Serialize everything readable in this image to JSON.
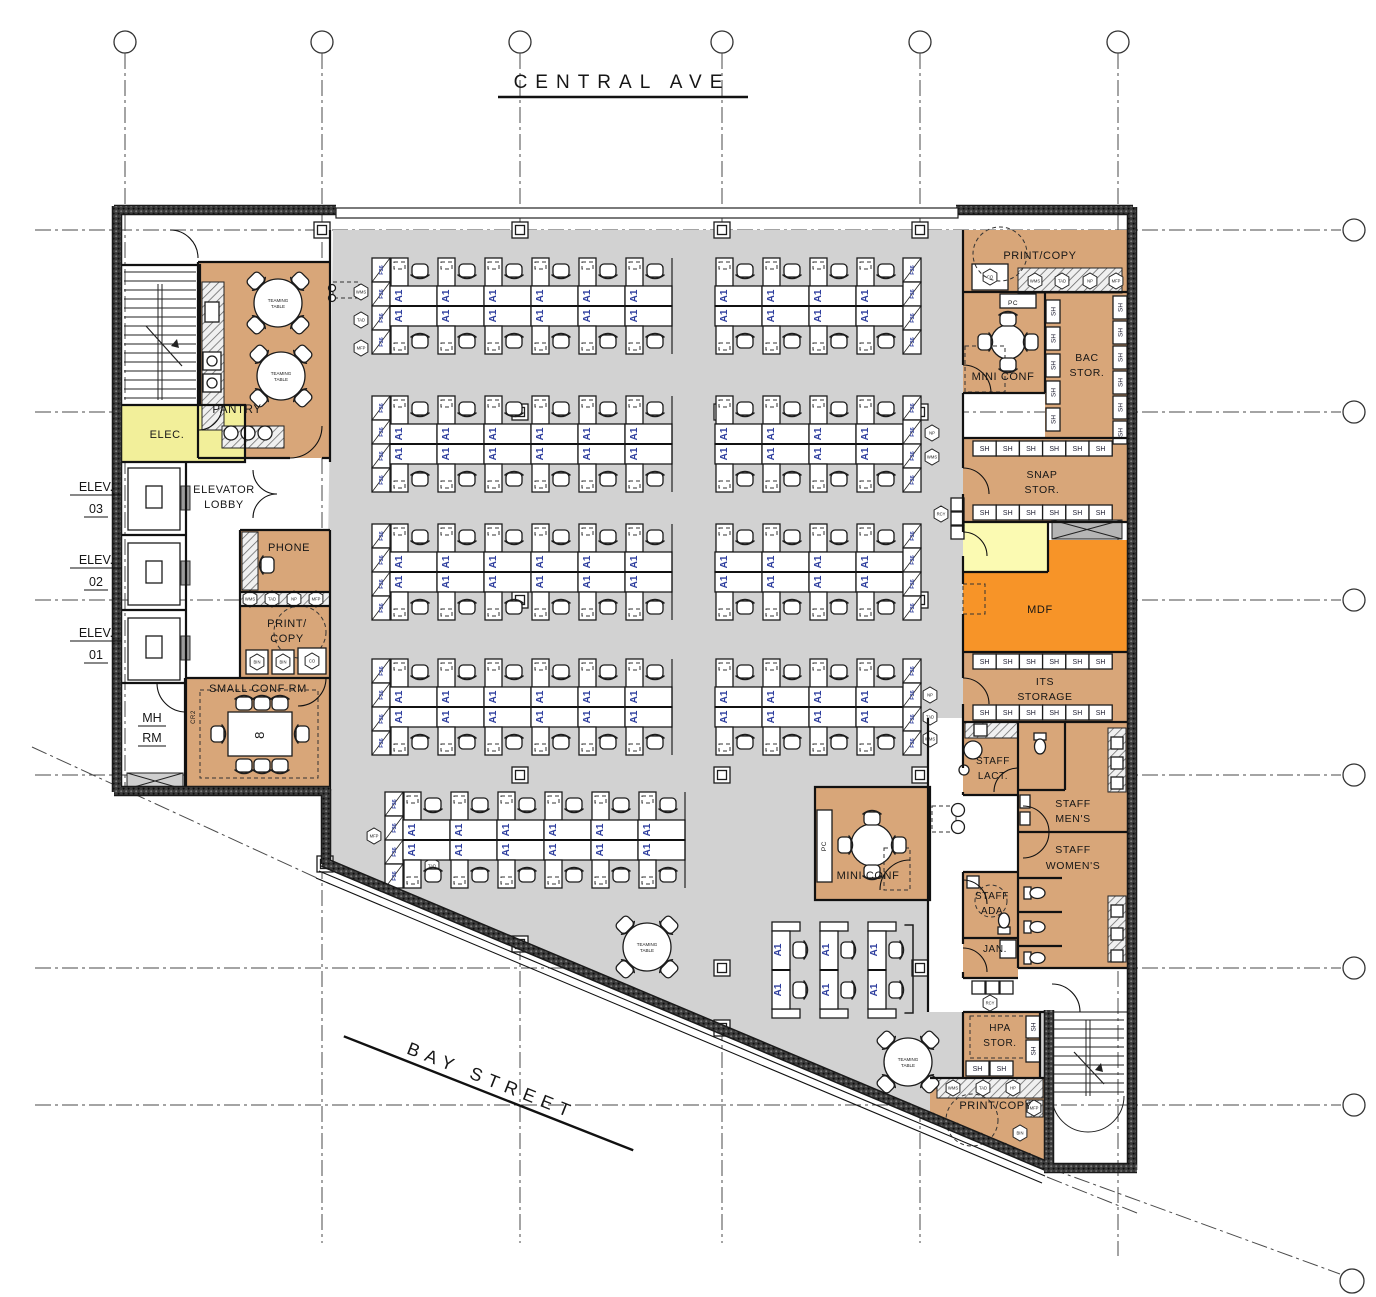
{
  "streets": {
    "top": "CENTRAL AVE",
    "bottom": "BAY STREET"
  },
  "core": {
    "elev03_l1": "ELEV.",
    "elev03_l2": "03",
    "elev02_l1": "ELEV.",
    "elev02_l2": "02",
    "elev01_l1": "ELEV.",
    "elev01_l2": "01",
    "mh_l1": "MH",
    "mh_l2": "RM",
    "elec": "ELEC.",
    "pantry": "PANTRY",
    "lobby_l1": "ELEVATOR",
    "lobby_l2": "LOBBY",
    "phone": "PHONE",
    "print_copy_l1": "PRINT/",
    "print_copy_l2": "COPY",
    "small_conf": "SMALL CONF RM",
    "table_seats": "8",
    "cr2": "CR2"
  },
  "east": {
    "print_copy_top": "PRINT/COPY",
    "pc": "PC",
    "mini_conf": "MINI CONF",
    "bac_l1": "BAC",
    "bac_l2": "STOR.",
    "snap_l1": "SNAP",
    "snap_l2": "STOR.",
    "mdf": "MDF",
    "its_l1": "ITS",
    "its_l2": "STORAGE",
    "lact_l1": "STAFF",
    "lact_l2": "LACT.",
    "mens_l1": "STAFF",
    "mens_l2": "MEN'S",
    "womens_l1": "STAFF",
    "womens_l2": "WOMEN'S",
    "ada_l1": "STAFF",
    "ada_l2": "ADA",
    "jan": "JAN.",
    "hpa_l1": "HPA",
    "hpa_l2": "STOR.",
    "print_copy_south": "PRINT/COPY",
    "mini_conf_south": "MINI CONF"
  },
  "tags": {
    "ws": "A1",
    "sh": "SH",
    "file": "F36",
    "teaming_l1": "TEAMING",
    "teaming_l2": "TABLE",
    "pc": "PC"
  },
  "equipment": [
    "WMS",
    "TAD",
    "NP",
    "MFP",
    "CO",
    "BIN",
    "HP",
    "RCY"
  ],
  "colors": {
    "open_office": "#d2d2d2",
    "room_tan": "#d8a679",
    "mdf_orange": "#f79428",
    "elec_yellow": "#f2ef9a",
    "pale_yellow": "#fbfab2",
    "wall_dark": "#3c3c3c",
    "tag_blue": "#2e3e9e"
  }
}
